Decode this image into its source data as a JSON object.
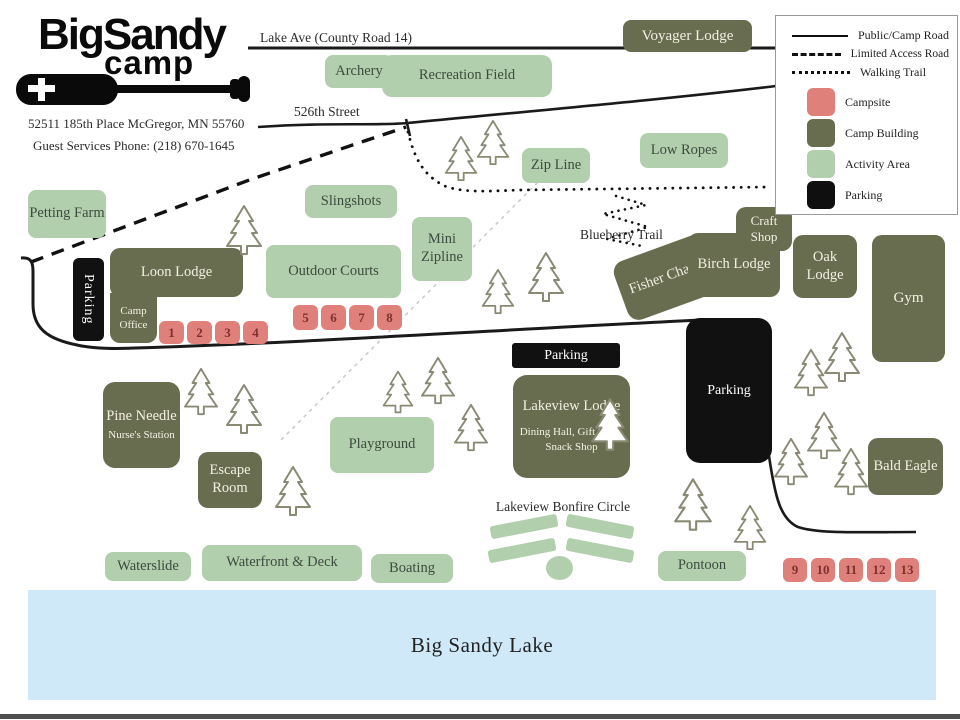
{
  "colors": {
    "activity_area": "#b2cfad",
    "camp_building": "#696d50",
    "campsite": "#e0807b",
    "parking": "#111111",
    "lake": "#cfe9f9",
    "road": "#1a1a1a",
    "tree_outline": "#8a8a74"
  },
  "logo": {
    "big": "Big",
    "sandy": "Sandy",
    "camp": "camp"
  },
  "contact": {
    "address": "52511 185th Place McGregor, MN 55760",
    "phone": "Guest Services Phone: (218) 670-1645"
  },
  "roads": {
    "lake_ave": "Lake Ave (County Road 14)",
    "street_526": "526th Street",
    "blueberry": "Blueberry Trail"
  },
  "legend": {
    "road_solid": "Public/Camp Road",
    "road_dashed": "Limited Access Road",
    "trail": "Walking Trail",
    "campsite": "Campsite",
    "building": "Camp Building",
    "activity": "Activity Area",
    "parking": "Parking"
  },
  "activities": {
    "petting_farm": "Petting Farm",
    "archery": "Archery",
    "recreation_field": "Recreation Field",
    "slingshots": "Slingshots",
    "zip_line": "Zip Line",
    "low_ropes": "Low Ropes",
    "mini_zipline": "Mini Zipline",
    "outdoor_courts": "Outdoor Courts",
    "playground": "Playground",
    "waterslide": "Waterslide",
    "waterfront": "Waterfront & Deck",
    "boating": "Boating",
    "pontoon": "Pontoon",
    "bonfire": "Lakeview Bonfire Circle"
  },
  "buildings": {
    "voyager": "Voyager Lodge",
    "loon": "Loon Lodge",
    "camp_office": "Camp Office",
    "craft_shop": "Craft Shop",
    "fisher_chapel": "Fisher Chapel",
    "birch": "Birch Lodge",
    "oak": "Oak Lodge",
    "gym": "Gym",
    "lakeview": "Lakeview Lodge",
    "lakeview_sub": "Dining Hall, Gift Shop, Snack Shop",
    "pine_needle": "Pine Needle",
    "pine_needle_sub": "Nurse's Station",
    "escape_room": "Escape Room",
    "bald_eagle": "Bald Eagle"
  },
  "parking": {
    "west": "Parking",
    "central": "Parking",
    "east": "Parking"
  },
  "campsites": [
    "1",
    "2",
    "3",
    "4",
    "5",
    "6",
    "7",
    "8",
    "9",
    "10",
    "11",
    "12",
    "13"
  ],
  "lake": {
    "name": "Big Sandy Lake"
  }
}
